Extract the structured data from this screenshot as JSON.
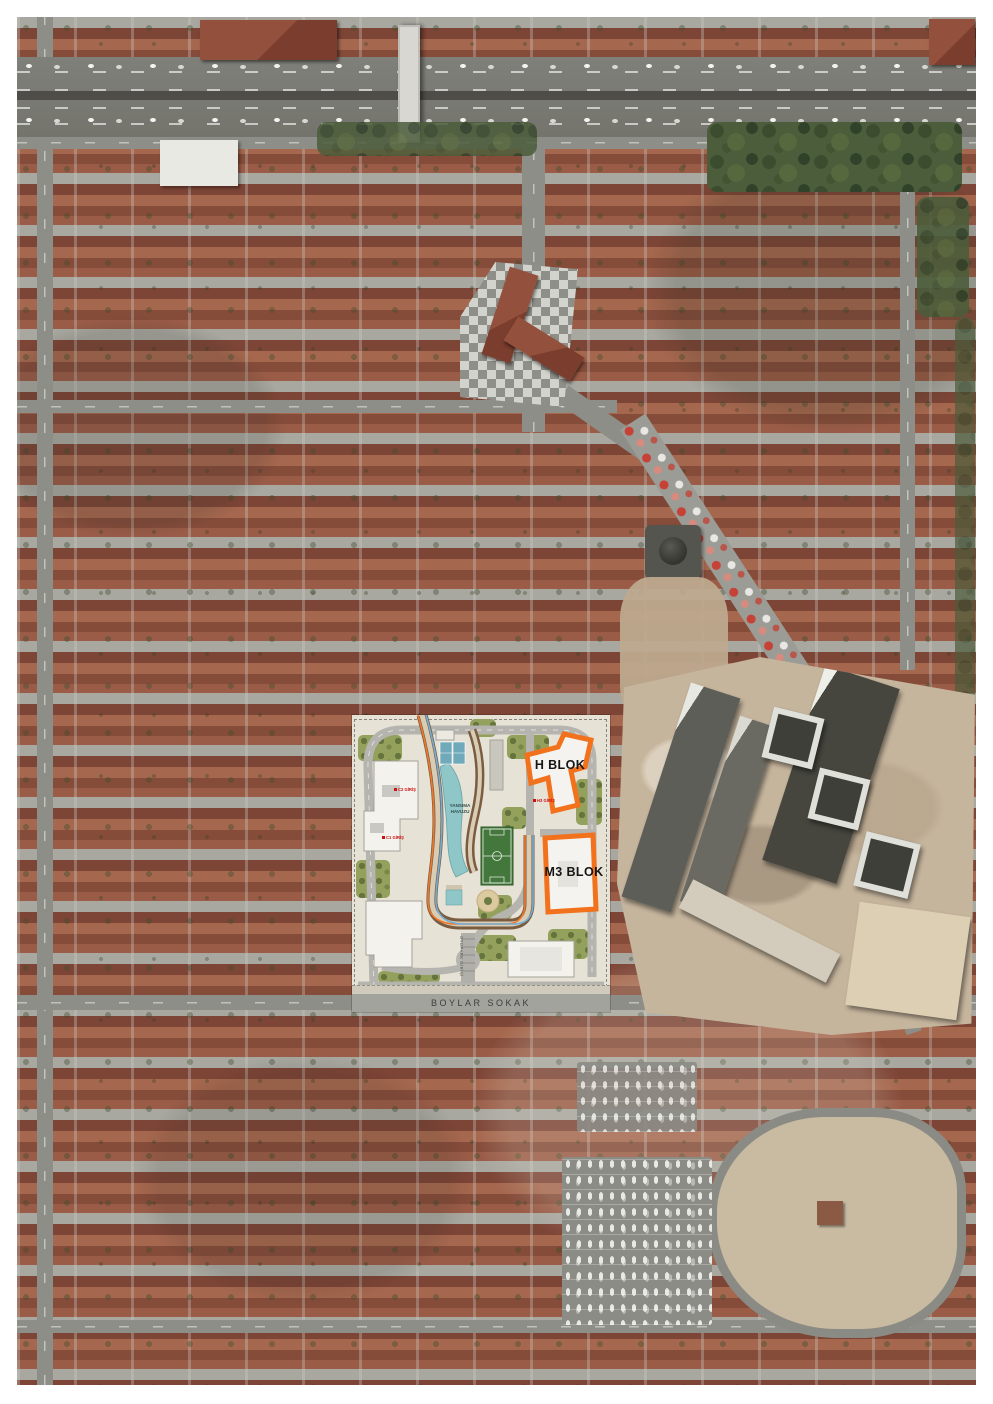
{
  "site_plan": {
    "h_block_label": "H BLOK",
    "m3_block_label": "M3 BLOK",
    "street_label": "BOYLAR SOKAK",
    "pool_label": {
      "line1": "YANSIMA",
      "line2": "HAVUZU"
    },
    "entrances": {
      "c2": "C2 GİRİŞ",
      "c1": "C1 GİRİŞ",
      "h3": "H3 GİRİŞ"
    },
    "parking_ramp_label": "OTOPARK GİRİŞİ",
    "colors": {
      "block_outline_orange": "#F2711C",
      "plan_ground": "#E7E2D6",
      "water_teal": "#8FC6C8",
      "pitch_green": "#44773C",
      "landscape_green": "#93A15C",
      "entrance_red": "#CC1111",
      "street_band_grey": "#A3A39D"
    }
  }
}
